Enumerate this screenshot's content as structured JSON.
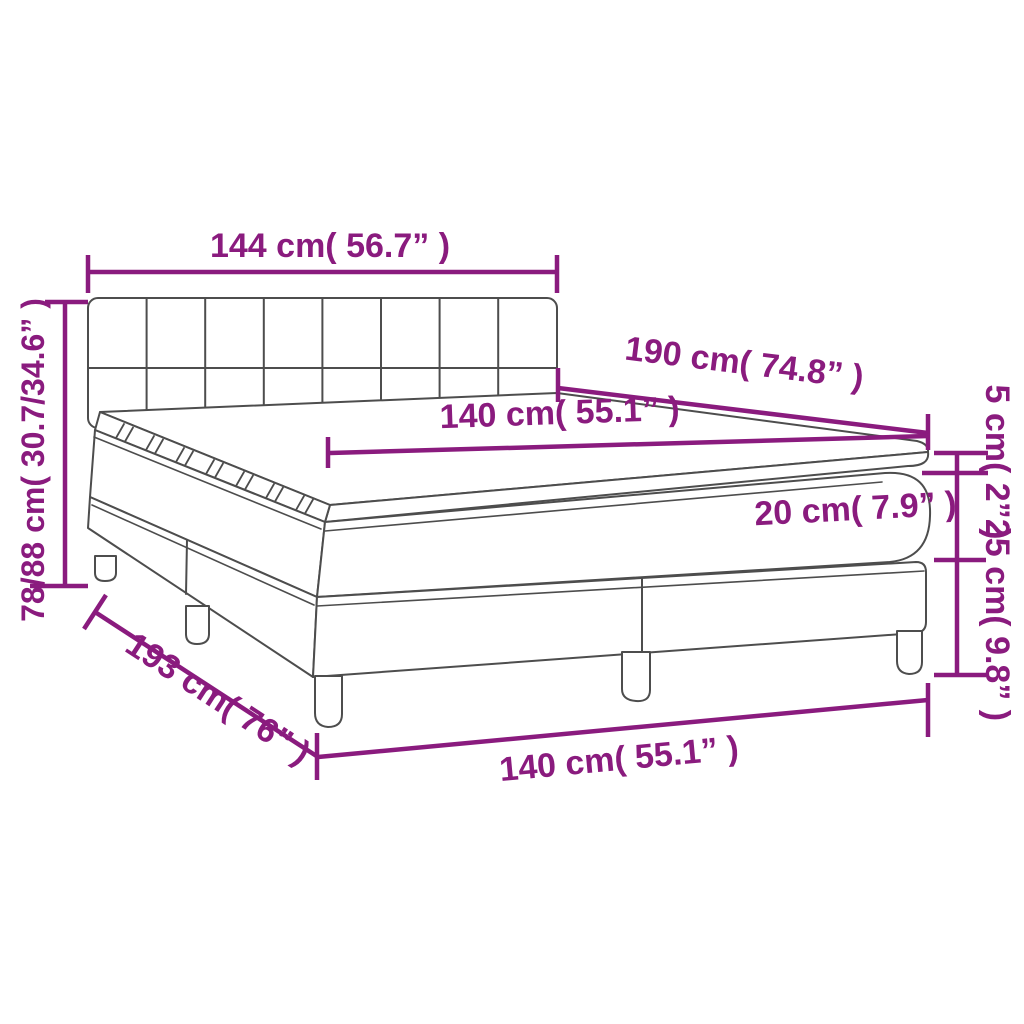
{
  "figure": {
    "kind": "furniture dimension diagram",
    "subject": "box spring bed with tufted headboard, base on legs, mattress and mattress topper"
  },
  "colors": {
    "dimension_annotations": "#8A1B7E",
    "product_outline": "#4D4D4D",
    "background": "#FFFFFF"
  },
  "labels": {
    "headboard_width": "144 cm( 56.7” )",
    "overall_height": "78/88 cm( 30.7/34.6” )",
    "mattress_length": "190 cm( 74.8” )",
    "mattress_top_width": "140 cm( 55.1” )",
    "topper_thickness": "5 cm( 2” )",
    "mattress_thickness": "20 cm( 7.9” )",
    "base_height": "25 cm( 9.8” )",
    "overall_length": "193 cm( 76” )",
    "base_width": "140 cm( 55.1” )"
  }
}
